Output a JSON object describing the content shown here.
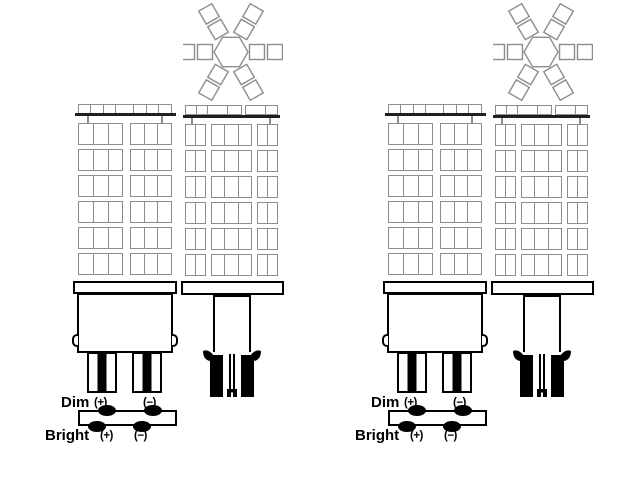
{
  "colors": {
    "background": "#ffffff",
    "led_outline": "#8d8d8d",
    "board_line": "#1f1f1f",
    "base_outline": "#000000",
    "text": "#000000"
  },
  "led_grids": {
    "front": {
      "rows": 6,
      "modules": [
        {
          "cells": 3,
          "flex": 1
        },
        {
          "cells": 3,
          "flex": 0.92
        }
      ],
      "top_cells": [
        1,
        1,
        1,
        1.5,
        1,
        1,
        1
      ]
    },
    "side": {
      "rows": 6,
      "modules": [
        {
          "cells": 2,
          "flex": 1
        },
        {
          "cells": 3,
          "flex": 2.1
        },
        {
          "cells": 2,
          "flex": 1
        }
      ],
      "top_cells": [
        1,
        1,
        1.8,
        1.2,
        0,
        1.8,
        1
      ]
    }
  },
  "star": {
    "arm_angles": [
      0,
      60,
      120,
      180,
      240,
      300
    ],
    "square_offsets": [
      26,
      44
    ],
    "square_size": 15,
    "hex_radius": 17
  },
  "groups": [
    {
      "terminals": {
        "dim_label": "Dim",
        "dim_plus": "(+)",
        "dim_minus": "(−)",
        "bright_label": "Bright",
        "bright_plus": "(+)",
        "bright_minus": "(−)"
      }
    },
    {
      "terminals": {
        "dim_label": "Dim",
        "dim_plus": "(+)",
        "dim_minus": "(−)",
        "bright_label": "Bright",
        "bright_plus": "(+)",
        "bright_minus": "(−)"
      }
    }
  ]
}
